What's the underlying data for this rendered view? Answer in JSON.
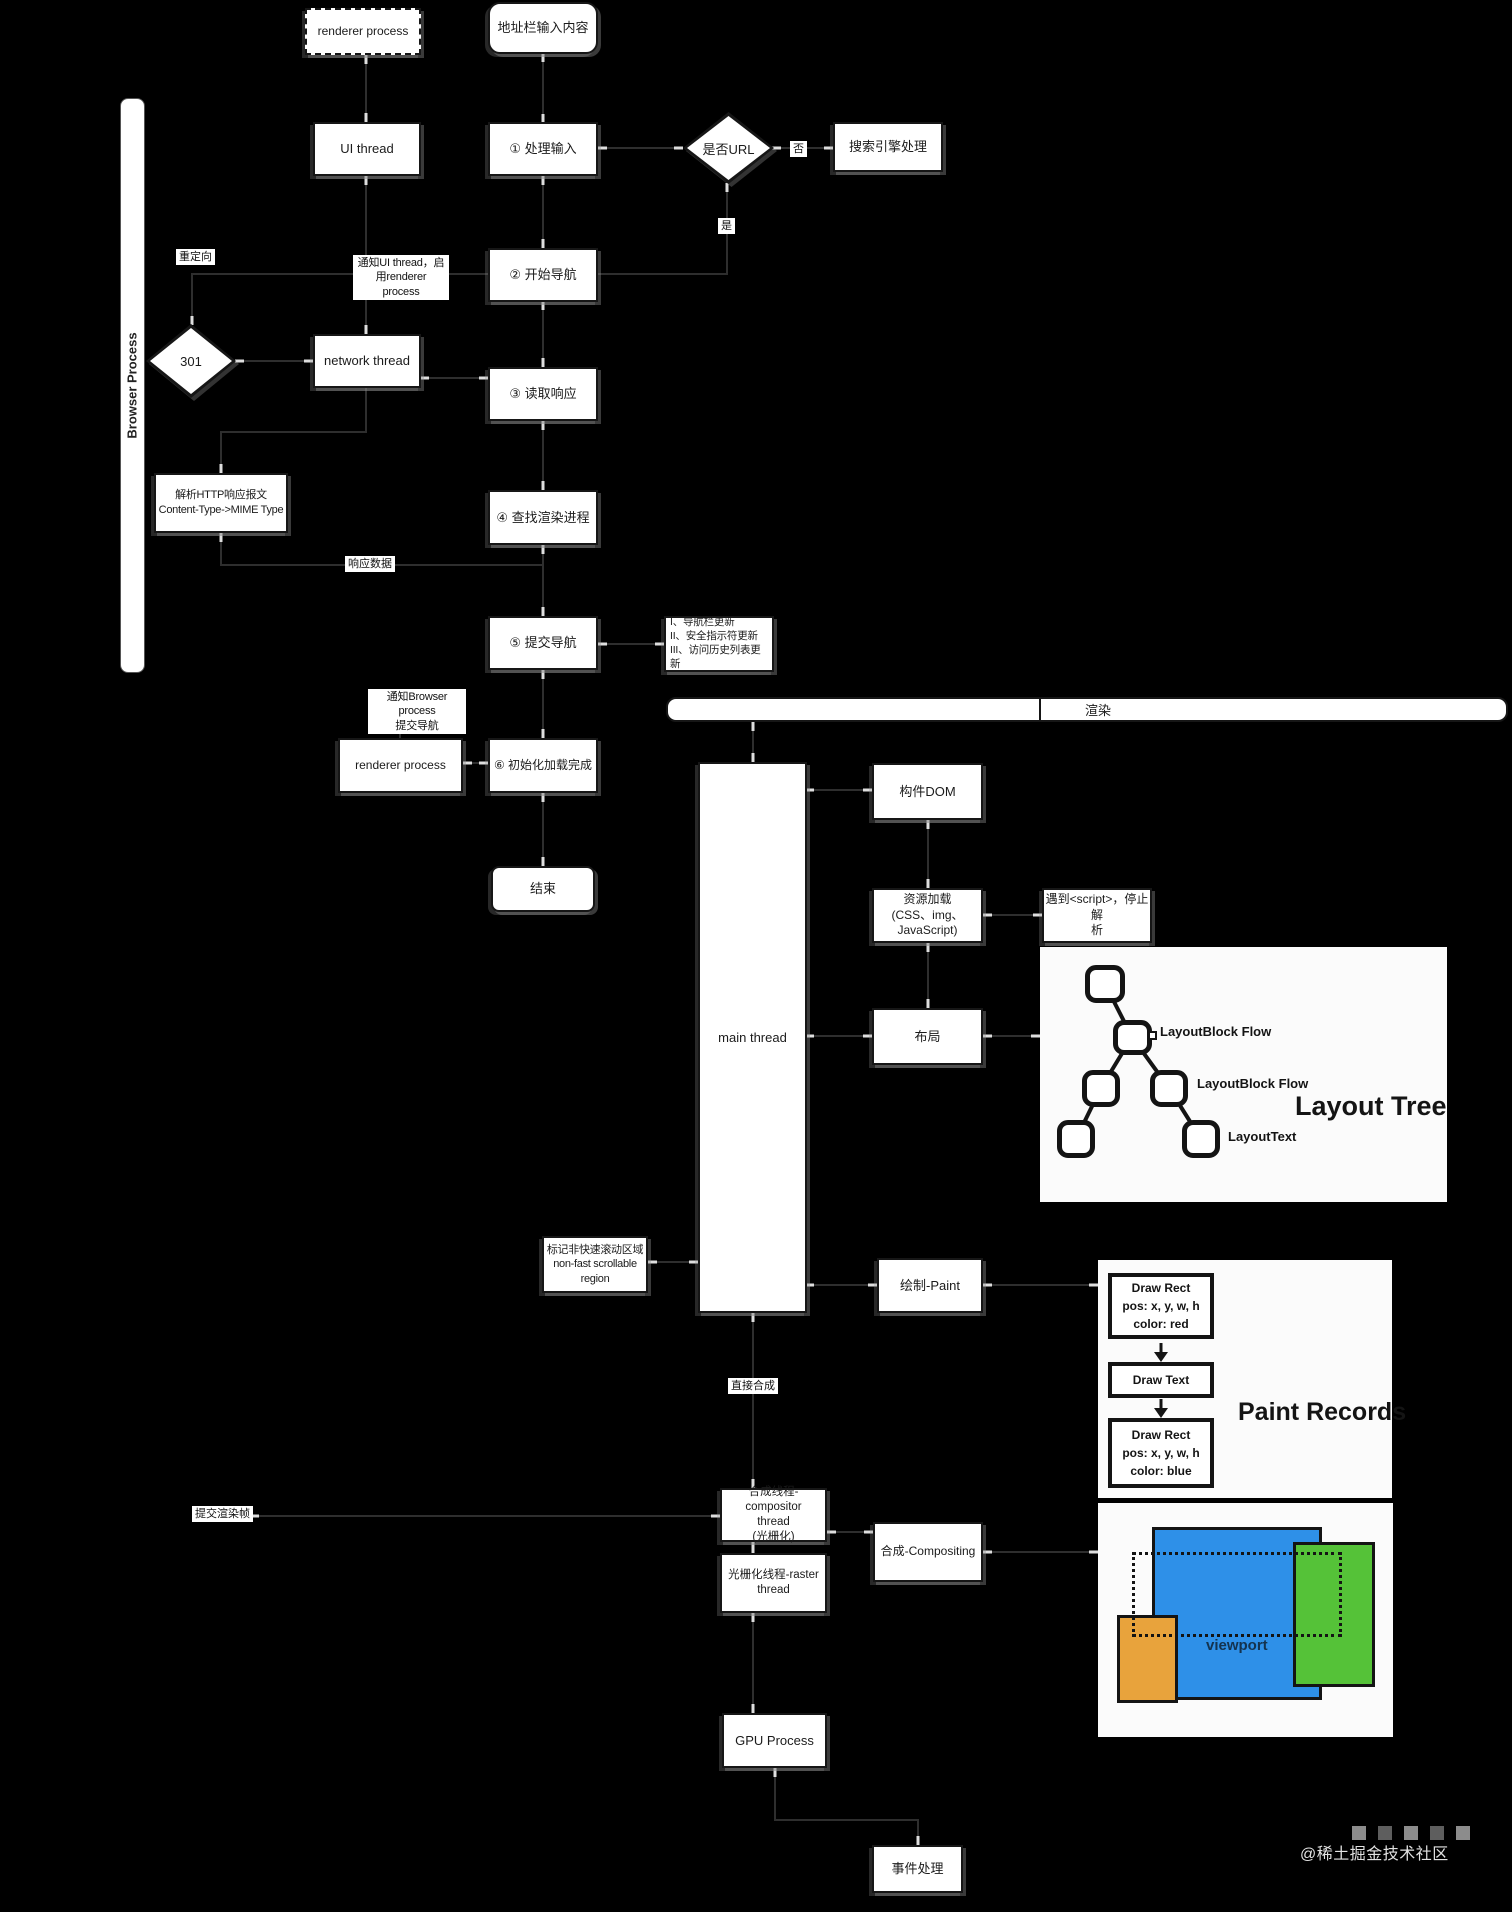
{
  "watermark": "@稀土掘金技术社区",
  "process_label": "Browser Process",
  "boxes": {
    "renderer_top": "renderer process",
    "addr_input": "地址栏输入内容",
    "ui_thread": "UI thread",
    "step1": "① 处理输入",
    "is_url": "是否URL",
    "no": "否",
    "yes": "是",
    "search_engine": "搜索引擎处理",
    "notify_ui": "通知UI thread，启\n用renderer process",
    "step2": "② 开始导航",
    "redirect": "重定向",
    "r301": "301",
    "network_thread": "network thread",
    "step3": "③ 读取响应",
    "parse_http": "解析HTTP响应报文\nContent-Type->MIME Type",
    "step4": "④ 查找渲染进程",
    "resp_data": "响应数据",
    "step5": "⑤ 提交导航",
    "updates": "I、导航栏更新\nII、安全指示符更新\nIII、访问历史列表更新",
    "notify_browser": "通知Browser process\n提交导航",
    "renderer2": "renderer process",
    "step6": "⑥ 初始化加载完成",
    "end": "结束",
    "render_bar": "渲染",
    "main_thread": "main thread",
    "build_dom": "构件DOM",
    "res_load": "资源加载\n(CSS、img、\nJavaScript)",
    "script_stop": "遇到<script>，停止解\n析",
    "layout": "布局",
    "mark_region": "标记非快速滚动区域\nnon-fast scrollable\nregion",
    "paint": "绘制-Paint",
    "direct": "直接合成",
    "compositor": "合成线程-compositor\nthread\n(光栅化)",
    "raster": "光栅化线程-raster\nthread",
    "compositing": "合成-Compositing",
    "commit_frame": "提交渲染帧",
    "gpu": "GPU Process",
    "event": "事件处理"
  },
  "layout_tree": {
    "title": "Layout Tree",
    "label1": "LayoutBlock Flow",
    "label2": "LayoutBlock Flow",
    "label3": "LayoutText"
  },
  "paint_records": {
    "title": "Paint Records",
    "b1": "Draw Rect\npos: x, y, w, h\ncolor: red",
    "b2": "Draw Text",
    "b3": "Draw Rect\npos: x, y, w, h\ncolor: blue"
  },
  "viewport_panel": {
    "label": "viewport"
  },
  "colors": {
    "blue": "#2E90E8",
    "green": "#55C238",
    "orange": "#E8A33C",
    "background": "#000000"
  }
}
